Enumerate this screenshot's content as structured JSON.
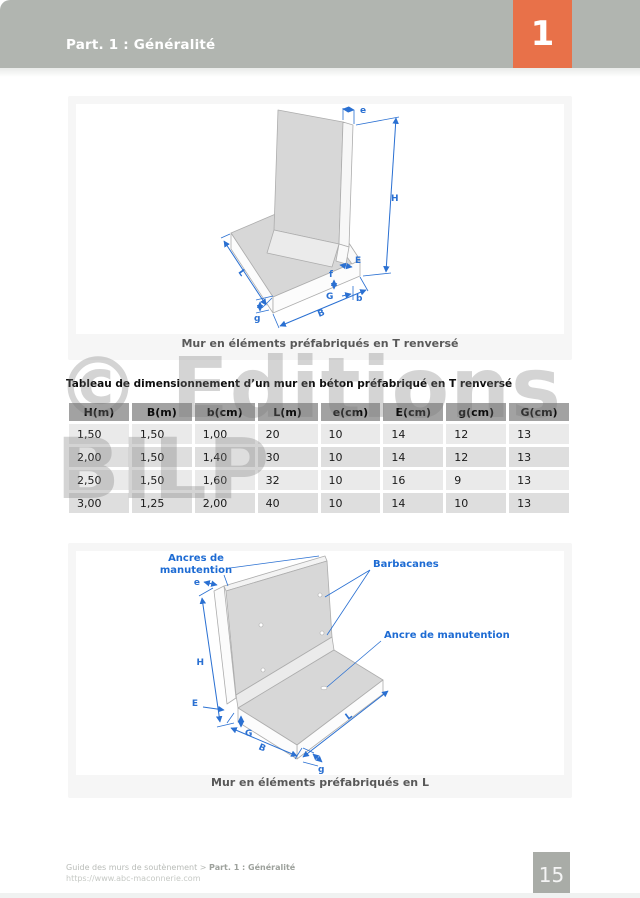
{
  "header": {
    "title": "Part. 1 : Généralité",
    "chapter": "1"
  },
  "fig1": {
    "caption": "Mur en éléments préfabriqués en T renversé",
    "dims": {
      "e": "e",
      "H": "H",
      "E": "E",
      "f": "f",
      "G": "G",
      "b": "b",
      "B": "B",
      "g": "g",
      "L": "L"
    }
  },
  "table": {
    "title": "Tableau de dimensionnement d’un mur en béton préfabriqué en T renversé",
    "headers": [
      "H(m)",
      "B(m)",
      "b(cm)",
      "L(m)",
      "e(cm)",
      "E(cm)",
      "g(cm)",
      "G(cm)"
    ],
    "rows": [
      [
        "1,50",
        "1,50",
        "1,00",
        "20",
        "10",
        "14",
        "12",
        "13"
      ],
      [
        "2,00",
        "1,50",
        "1,40",
        "30",
        "10",
        "14",
        "12",
        "13"
      ],
      [
        "2,50",
        "1,50",
        "1,60",
        "32",
        "10",
        "16",
        "9",
        "13"
      ],
      [
        "3,00",
        "1,25",
        "2,00",
        "40",
        "10",
        "14",
        "10",
        "13"
      ]
    ]
  },
  "watermark": {
    "line1": "© Editions",
    "line2": "BILP"
  },
  "fig2": {
    "caption": "Mur en éléments préfabriqués en L",
    "labels": {
      "ancres_l1": "Ancres de",
      "ancres_l2": "manutention",
      "barbacanes": "Barbacanes",
      "ancre": "Ancre de manutention"
    },
    "dims": {
      "e": "e",
      "H": "H",
      "E": "E",
      "G": "G",
      "B": "B",
      "g": "g",
      "L": "L"
    }
  },
  "footer": {
    "crumb": "Guide des murs de soutènement > ",
    "crumb_bold": "Part. 1 : Généralité",
    "url": "https://www.abc-maconnerie.com",
    "page": "15"
  }
}
